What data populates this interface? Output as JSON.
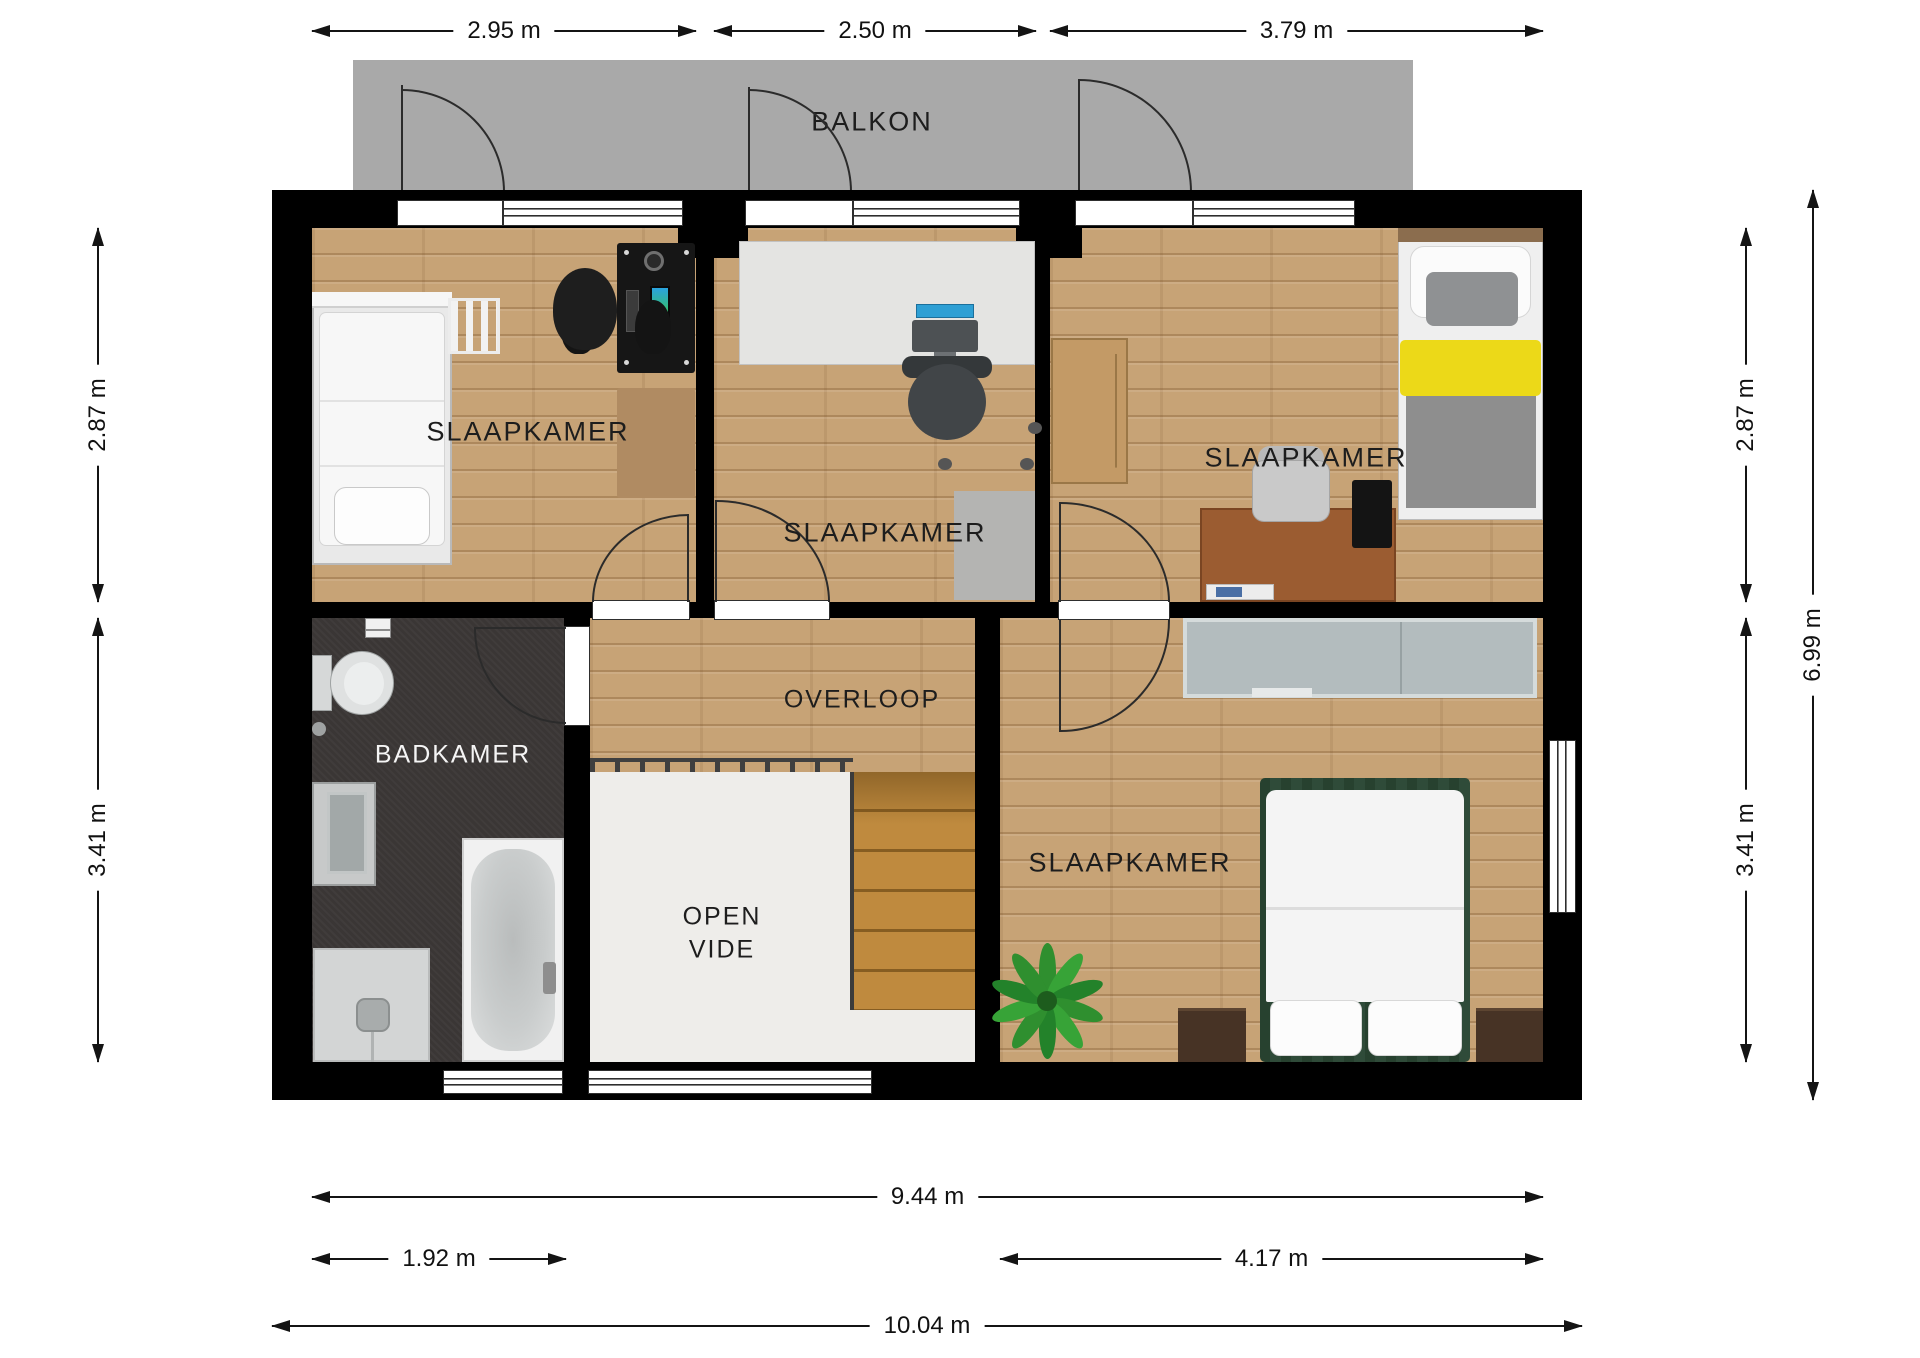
{
  "plan": {
    "type": "floorplan-first-floor",
    "units": "m",
    "scale_px_per_m": 130.5,
    "colors": {
      "wall": "#000000",
      "wood_floor": "#c7a376",
      "bathroom_floor": "#3a3635",
      "open_vide_floor": "#eeedea",
      "balcony": "#a9a9a9",
      "stairs": "#bf8a3e",
      "bed_yellow": "#ecd918",
      "bed_green_frame": "#2f4b39",
      "wardrobe_gray": "#b3bcbe",
      "dimension_text": "#111111"
    }
  },
  "rooms": {
    "balkon": "BALKON",
    "slaapkamer": "SLAAPKAMER",
    "badkamer": "BADKAMER",
    "overloop": "OVERLOOP",
    "open_vide": [
      "OPEN",
      "VIDE"
    ]
  },
  "dimensions": {
    "top": [
      "2.95 m",
      "2.50 m",
      "3.79 m"
    ],
    "left": [
      "2.87 m",
      "3.41 m"
    ],
    "right_inner": [
      "2.87 m",
      "3.41 m"
    ],
    "right_outer": "6.99 m",
    "bottom_row1": "9.44 m",
    "bottom_row2": [
      "1.92 m",
      "4.17 m"
    ],
    "bottom_row3": "10.04 m"
  },
  "furniture_icons": {
    "bedroom_1": [
      "single-bed-icon",
      "ladder-icon",
      "gaming-desk-icon",
      "gaming-chair-icon",
      "rug-icon"
    ],
    "bedroom_2": [
      "desk-icon",
      "monitor-icon",
      "office-chair-icon",
      "rug-icon"
    ],
    "bedroom_3": [
      "wardrobe-icon",
      "single-bed-yellow-icon",
      "desk-icon",
      "chair-icon",
      "laptop-icon"
    ],
    "bedroom_4": [
      "sliding-wardrobe-icon",
      "double-bed-icon",
      "nightstand-icon",
      "nightstand-icon",
      "plant-icon"
    ],
    "bathroom": [
      "toilet-icon",
      "toilet-paper-icon",
      "washbasin-icon",
      "shower-icon",
      "bathtub-icon"
    ],
    "circulation": [
      "stairs-icon",
      "railing-icon",
      "door-swing-icon"
    ]
  }
}
